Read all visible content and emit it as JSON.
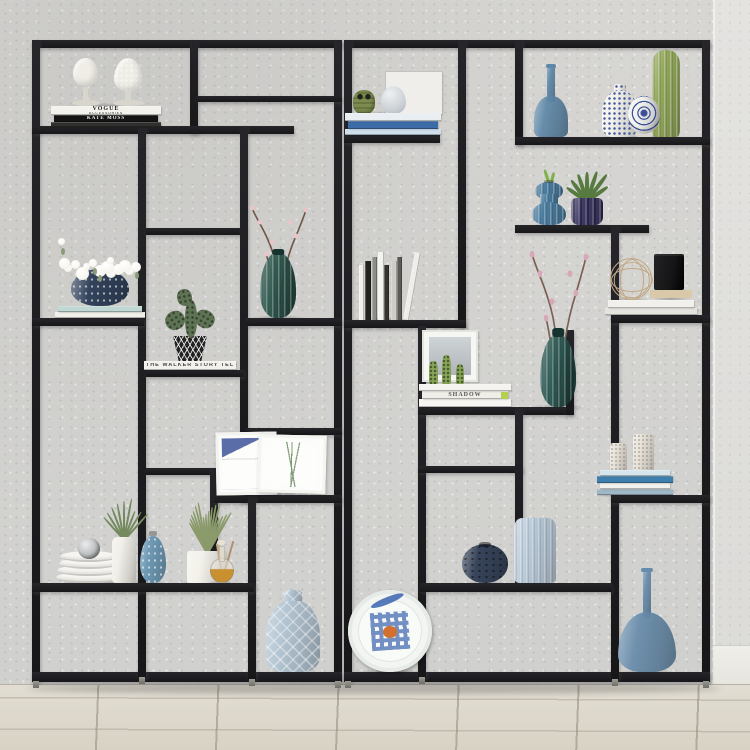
{
  "scene": {
    "width": 750,
    "height": 750,
    "wall_color": "#d7d6d3",
    "wall_right_color": "#e4e3e0",
    "baseboard_color": "#e6e4de",
    "floor_color": "#d8d2c5",
    "frame_color": "#17171a",
    "accent_blue": "#5e88a8",
    "accent_green": "#5e7254"
  },
  "frame": {
    "bars": [
      [
        32,
        40,
        310,
        8
      ],
      [
        32,
        40,
        8,
        642
      ],
      [
        334,
        40,
        8,
        642
      ],
      [
        32,
        672,
        310,
        10
      ],
      [
        190,
        40,
        8,
        94
      ],
      [
        196,
        96,
        146,
        6
      ],
      [
        32,
        126,
        262,
        8
      ],
      [
        138,
        126,
        8,
        552
      ],
      [
        146,
        228,
        100,
        7
      ],
      [
        240,
        126,
        8,
        377
      ],
      [
        32,
        318,
        112,
        8
      ],
      [
        246,
        318,
        96,
        8
      ],
      [
        146,
        370,
        98,
        7
      ],
      [
        246,
        428,
        96,
        7
      ],
      [
        146,
        468,
        70,
        7
      ],
      [
        210,
        468,
        8,
        122
      ],
      [
        214,
        495,
        128,
        8
      ],
      [
        248,
        495,
        8,
        185
      ],
      [
        32,
        583,
        222,
        9
      ],
      [
        344,
        40,
        366,
        8
      ],
      [
        344,
        40,
        8,
        642
      ],
      [
        702,
        40,
        8,
        642
      ],
      [
        344,
        672,
        366,
        10
      ],
      [
        458,
        40,
        8,
        288
      ],
      [
        515,
        40,
        8,
        105
      ],
      [
        344,
        135,
        96,
        8
      ],
      [
        515,
        137,
        195,
        8
      ],
      [
        515,
        225,
        134,
        8
      ],
      [
        611,
        225,
        8,
        455
      ],
      [
        611,
        315,
        99,
        8
      ],
      [
        344,
        320,
        122,
        8
      ],
      [
        418,
        326,
        8,
        352
      ],
      [
        418,
        407,
        154,
        8
      ],
      [
        566,
        330,
        8,
        85
      ],
      [
        418,
        466,
        105,
        7
      ],
      [
        515,
        409,
        8,
        178
      ],
      [
        420,
        583,
        192,
        9
      ],
      [
        611,
        495,
        99,
        8
      ]
    ],
    "feet": [
      [
        33,
        681
      ],
      [
        139,
        677
      ],
      [
        249,
        679
      ],
      [
        335,
        681
      ],
      [
        345,
        681
      ],
      [
        419,
        677
      ],
      [
        612,
        679
      ],
      [
        703,
        681
      ]
    ]
  },
  "items": [
    {
      "name": "finial-pair",
      "type": "finials",
      "x": 60,
      "y": 58,
      "w": 92,
      "h": 48,
      "c1": "#efede6",
      "c2": "#d8d5cc"
    },
    {
      "name": "vogue-books",
      "type": "books-flat",
      "x": 50,
      "y": 106,
      "w": 112,
      "h": 21,
      "books": [
        {
          "label": "VOGUE",
          "sub": "ACCESSORIES",
          "bg": "#f4f2ec",
          "fg": "#1c1c1c",
          "h": 9
        },
        {
          "label": "KATE MOSS",
          "bg": "#141414",
          "fg": "#f0f0ee",
          "h": 7
        },
        {
          "label": "",
          "bg": "#30302e",
          "fg": "#aaaaaa",
          "h": 5
        }
      ]
    },
    {
      "name": "flower-pot",
      "type": "flower-pot",
      "x": 54,
      "y": 238,
      "w": 92,
      "h": 80,
      "pot": "#33435c",
      "books": [
        {
          "label": "",
          "bg": "#bfd8d3",
          "fg": "#556",
          "h": 6
        },
        {
          "label": "",
          "bg": "#f0efe9",
          "fg": "#556",
          "h": 6
        }
      ],
      "flower": "#f7f5ee",
      "leaf": "#8a9b77"
    },
    {
      "name": "cactus-pot",
      "type": "cactus-pot",
      "x": 144,
      "y": 286,
      "w": 92,
      "h": 84,
      "cactus": "#5e7254",
      "pot_bg": "#232324",
      "pot_fg": "#e8e6df",
      "book": {
        "label": "THE WALKER STORY TELLER",
        "bg": "#f2f1ec",
        "fg": "#4a4a48",
        "h": 9
      }
    },
    {
      "name": "blossom-vase-left",
      "type": "branch-vase",
      "x": 246,
      "y": 192,
      "w": 64,
      "h": 126,
      "c1": "#2e584e",
      "c2": "#17332d",
      "branch": "#6d5747",
      "blossom": "#e9c4cb"
    },
    {
      "name": "art-frames",
      "type": "frames",
      "x": 214,
      "y": 434,
      "w": 114,
      "h": 61,
      "accent1": "#5a6da8",
      "accent2": "#7e9b77"
    },
    {
      "name": "plate-stack",
      "type": "plates",
      "x": 56,
      "y": 538,
      "w": 66,
      "h": 45,
      "c1": "#f6f5f1",
      "orn": "#b9bcbd"
    },
    {
      "name": "airplant-cylinder",
      "type": "plant-cyl",
      "x": 100,
      "y": 500,
      "w": 48,
      "h": 83,
      "c1": "#f1efe8",
      "leaf": "#74895e"
    },
    {
      "name": "dotted-bud-vase",
      "type": "vase",
      "shape": "teardrop",
      "x": 140,
      "y": 528,
      "w": 26,
      "h": 55,
      "c1": "#6f9ab5",
      "pattern": "dots"
    },
    {
      "name": "lavender-planter",
      "type": "planter",
      "x": 176,
      "y": 498,
      "w": 62,
      "h": 85,
      "c1": "#f3f1ea",
      "leaf": "#8a9a6b"
    },
    {
      "name": "oil-bottle",
      "type": "oil-bottle",
      "x": 204,
      "y": 540,
      "w": 34,
      "h": 43,
      "z": 3,
      "liquid": "#c9902f"
    },
    {
      "name": "quilted-vase",
      "type": "vase",
      "shape": "jar",
      "x": 266,
      "y": 590,
      "w": 54,
      "h": 82,
      "c1": "#b3c5d2",
      "pattern": "diamond",
      "neck": 1
    },
    {
      "name": "deco-plate",
      "type": "deco-plate",
      "x": 348,
      "y": 590,
      "w": 84,
      "h": 82,
      "c1": "#f3f5f2",
      "c2": "#3b63b0",
      "c3": "#d2702f"
    },
    {
      "name": "owl-egg-books",
      "type": "ornament-group",
      "x": 346,
      "y": 72,
      "w": 96,
      "h": 42,
      "board": "#efeeea",
      "owl": "#7c8b4e",
      "egg": "#c9cfd4"
    },
    {
      "name": "blue-books",
      "type": "books-flat",
      "x": 344,
      "y": 112,
      "w": 98,
      "h": 23,
      "books": [
        {
          "label": "",
          "bg": "#e8eef2",
          "fg": "#3f6fae",
          "h": 8
        },
        {
          "label": "",
          "bg": "#3c6ca8",
          "fg": "#dbe6f2",
          "h": 8
        },
        {
          "label": "",
          "bg": "#cfdfeb",
          "fg": "#667",
          "h": 6
        }
      ]
    },
    {
      "name": "blue-glass-bottle",
      "type": "vase",
      "shape": "bottle",
      "x": 534,
      "y": 64,
      "w": 34,
      "h": 73,
      "c1": "#5e88a8",
      "glass": 1
    },
    {
      "name": "lattice-vase",
      "type": "vase",
      "shape": "jar",
      "x": 602,
      "y": 84,
      "w": 36,
      "h": 53,
      "c1": "#f3f2ec",
      "pattern": "lattice",
      "neck": 1
    },
    {
      "name": "orb-ornament",
      "type": "orb",
      "x": 625,
      "y": 92,
      "w": 38,
      "h": 45,
      "z": 3,
      "c1": "#f2f2ee",
      "c2": "#3b4f9b"
    },
    {
      "name": "green-cactus-vase",
      "type": "vase",
      "shape": "cactus",
      "x": 652,
      "y": 50,
      "w": 28,
      "h": 87,
      "c1": "#93a85b",
      "pattern": "ribs"
    },
    {
      "name": "wavy-bud-vase",
      "type": "vase",
      "shape": "hourglass",
      "x": 532,
      "y": 176,
      "w": 34,
      "h": 49,
      "c1": "#4b7da0",
      "pattern": "ribs",
      "leafed": 1,
      "leaf": "#7fb24c"
    },
    {
      "name": "purple-planter-plant",
      "type": "purple-plant",
      "x": 562,
      "y": 166,
      "w": 50,
      "h": 59,
      "c1": "#3f3a66",
      "leaf": "#567a40"
    },
    {
      "name": "upright-books",
      "type": "books-upright",
      "x": 356,
      "y": 248,
      "w": 56,
      "h": 72,
      "colors": [
        "#f2f1ed",
        "#22221f",
        "#8d8d8a",
        "#f4f3ef",
        "#343431",
        "#cfccc6",
        "#5a5a57",
        "#efeeea"
      ]
    },
    {
      "name": "wire-ball",
      "type": "wire-ball",
      "x": 610,
      "y": 258,
      "w": 42,
      "h": 42,
      "c1": "#c3a986"
    },
    {
      "name": "black-box",
      "type": "black-box",
      "x": 650,
      "y": 250,
      "w": 42,
      "h": 48,
      "c1": "#151515",
      "c2": "#d9c9a8"
    },
    {
      "name": "white-book-slab",
      "type": "books-flat",
      "x": 604,
      "y": 298,
      "w": 94,
      "h": 17,
      "books": [
        {
          "label": "",
          "bg": "#f1f0ec",
          "fg": "#888",
          "h": 8
        },
        {
          "label": "",
          "bg": "#e6e4de",
          "fg": "#888",
          "h": 7
        }
      ]
    },
    {
      "name": "shadow-books-vignette",
      "type": "shadow-stack",
      "x": 418,
      "y": 330,
      "w": 94,
      "h": 77,
      "candle": "#87a457",
      "accent": "#b3d14e",
      "books": [
        {
          "label": "",
          "bg": "#f4f3ef",
          "fg": "#999",
          "h": 7
        },
        {
          "label": "SHADOW",
          "bg": "#efeee9",
          "fg": "#55564f",
          "h": 8
        },
        {
          "label": "",
          "bg": "#f7f6f2",
          "fg": "#999",
          "h": 8
        }
      ]
    },
    {
      "name": "blossom-vase-right",
      "type": "branch-vase",
      "x": 526,
      "y": 232,
      "w": 64,
      "h": 175,
      "c1": "#2d5a54",
      "c2": "#16332f",
      "branch": "#7b5f52",
      "blossom": "#d8a8b8"
    },
    {
      "name": "candles-on-books",
      "type": "candles-books",
      "x": 596,
      "y": 430,
      "w": 78,
      "h": 65,
      "candle": "#e9e4da",
      "books": [
        {
          "label": "",
          "bg": "#d7e6ec",
          "fg": "#447",
          "h": 6
        },
        {
          "label": "",
          "bg": "#3f7fae",
          "fg": "#fff",
          "h": 7
        },
        {
          "label": "",
          "bg": "#f1f1ee",
          "fg": "#777",
          "h": 6
        },
        {
          "label": "",
          "bg": "#9fb8c6",
          "fg": "#fff",
          "h": 6
        }
      ]
    },
    {
      "name": "faceted-sphere-vase",
      "type": "vase",
      "shape": "sphere",
      "x": 462,
      "y": 544,
      "w": 46,
      "h": 39,
      "c1": "#37445a",
      "pattern": "darkdots"
    },
    {
      "name": "ribbed-cylinder-vase",
      "type": "vase",
      "shape": "cyl",
      "x": 514,
      "y": 518,
      "w": 42,
      "h": 65,
      "c1": "#bccddc",
      "pattern": "ribs"
    },
    {
      "name": "tall-blue-bottle",
      "type": "vase",
      "shape": "tallbottle",
      "x": 618,
      "y": 568,
      "w": 58,
      "h": 104,
      "c1": "#678cab",
      "glass": 1
    }
  ]
}
